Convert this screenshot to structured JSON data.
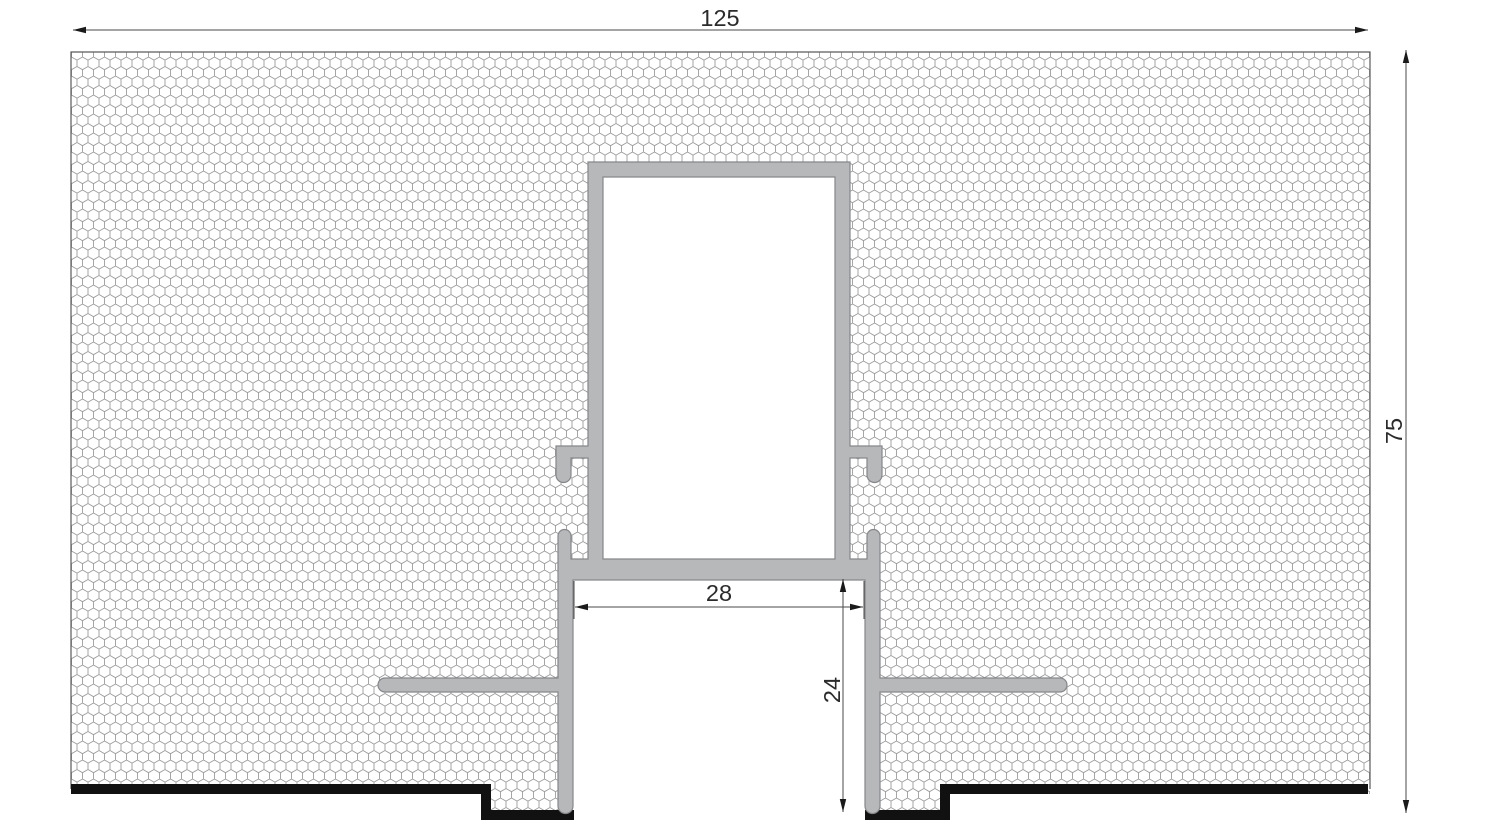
{
  "drawing": {
    "type": "technical-cross-section",
    "dimensions": {
      "overall_width": {
        "label": "125",
        "value": 125
      },
      "overall_height": {
        "label": "75",
        "value": 75
      },
      "opening_width": {
        "label": "28",
        "value": 28
      },
      "recess_depth": {
        "label": "24",
        "value": 24
      }
    },
    "colors": {
      "background": "#ffffff",
      "profile_fill": "#b7b8ba",
      "profile_stroke": "#85878a",
      "hatch_line": "#9c9c9c",
      "hatch_border": "#5a5a5a",
      "board_edge_black": "#111111",
      "dimension_line": "#4a4a4a",
      "dimension_text": "#2b2b2b"
    }
  }
}
